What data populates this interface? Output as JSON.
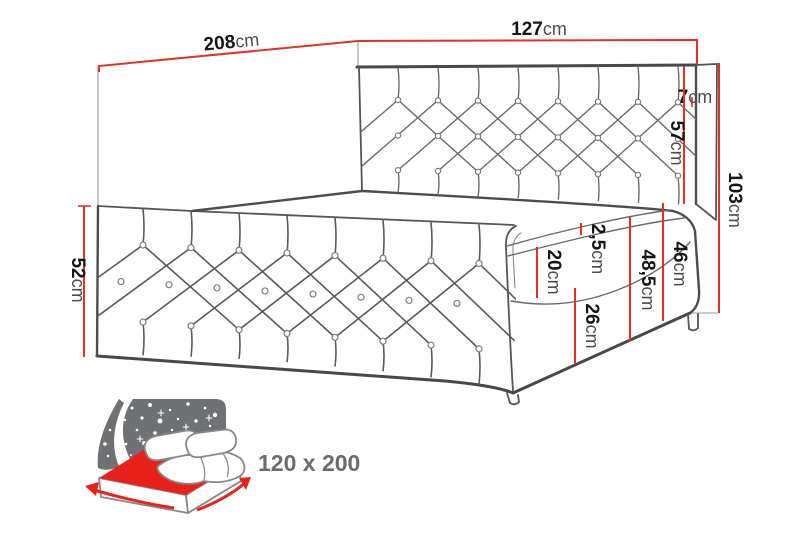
{
  "diagram": {
    "title_semantic": "bed-dimension-technical-drawing",
    "dimensions": {
      "total_length": {
        "value": "208",
        "unit": "cm"
      },
      "frame_width": {
        "value": "127",
        "unit": "cm"
      },
      "headboard_depth": {
        "value": "7",
        "unit": "cm"
      },
      "headboard_above_base": {
        "value": "57",
        "unit": "cm"
      },
      "total_height": {
        "value": "103",
        "unit": "cm"
      },
      "side_height": {
        "value": "52",
        "unit": "cm"
      },
      "topper_thickness": {
        "value": "2,5",
        "unit": "cm"
      },
      "mattress_thickness": {
        "value": "20",
        "unit": "cm"
      },
      "mattress_and_base_height": {
        "value": "48,5",
        "unit": "cm"
      },
      "height_under_headboard": {
        "value": "46",
        "unit": "cm"
      },
      "base_box_height": {
        "value": "26",
        "unit": "cm"
      }
    }
  },
  "size_badge": {
    "label": "120 x 200"
  },
  "colors": {
    "dimension_red": "#e23227",
    "icon_red": "#e8211a",
    "icon_gray": "#6f7173",
    "outline_dark": "#48484a",
    "badge_text": "#6a6c6e"
  }
}
